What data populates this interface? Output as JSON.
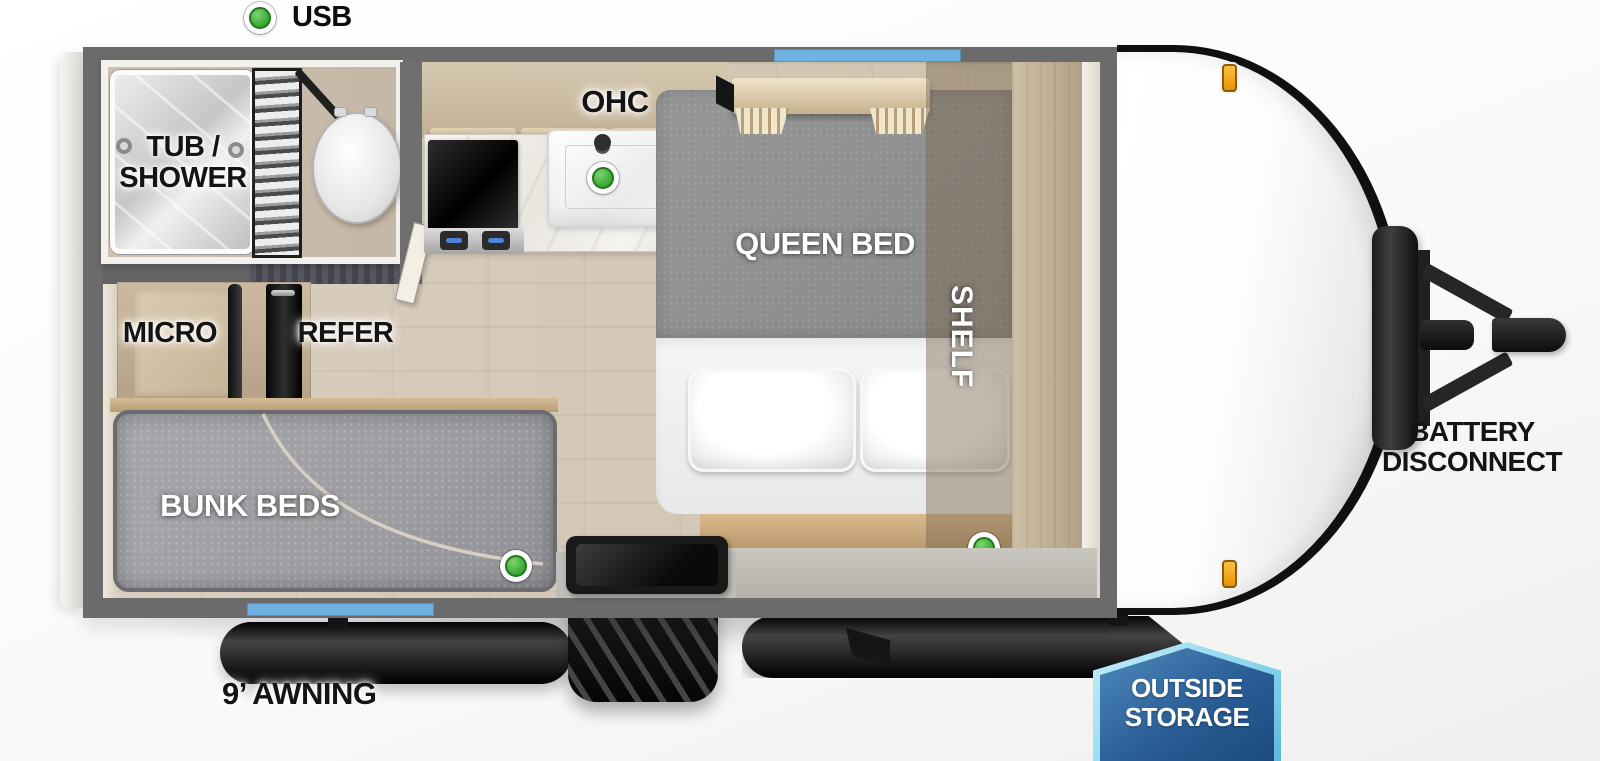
{
  "legend": {
    "usb": "USB"
  },
  "labels": {
    "tub_1": "TUB /",
    "tub_2": "SHOWER",
    "ohc": "OHC",
    "micro": "MICRO",
    "refer": "REFER",
    "bunk": "BUNK BEDS",
    "queen": "QUEEN BED",
    "shelf": "SHELF",
    "awning": "9’ AWNING",
    "battery_1": "BATTERY",
    "battery_2": "DISCONNECT",
    "storage_1": "OUTSIDE",
    "storage_2": "STORAGE"
  },
  "icons": {
    "usb_indicator": "green circle = USB charge point",
    "marker_light": "amber clearance light"
  },
  "colors": {
    "wall_gray": "#6b6b6b",
    "floor_wood": "#d5c9b8",
    "cabinet_wood": "#c2b095",
    "window_blue": "#6fb2e2",
    "usb_green": "#3fae3a",
    "marker_orange": "#e8920d",
    "badge_border_blue": "#8fd8f0",
    "badge_fill_blue": "#2a5e96",
    "mattress_gray": "#9d9da1",
    "bed_blanket_gray": "#8e8e8e"
  }
}
